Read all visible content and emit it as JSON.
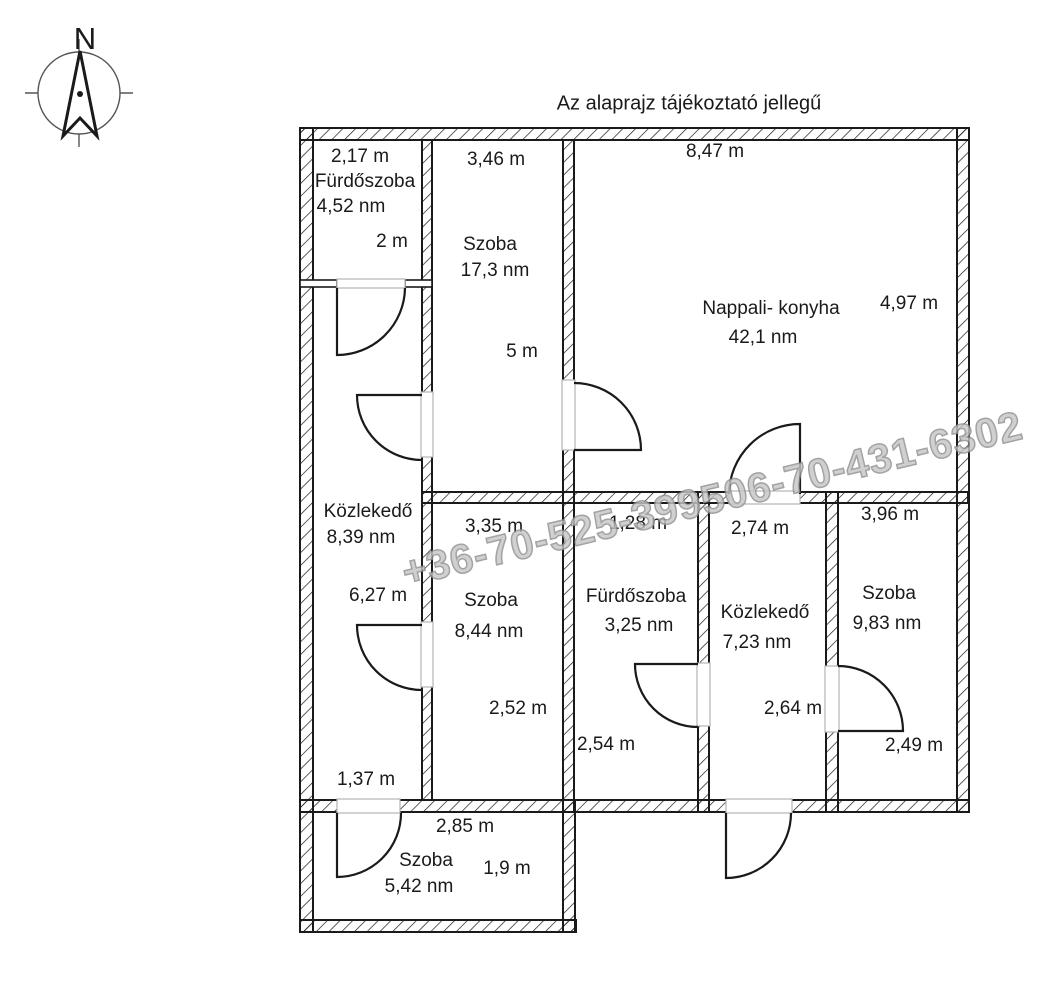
{
  "title": "Az alaprajz tájékoztató jellegű",
  "compass": {
    "north_label": "N"
  },
  "watermark": {
    "text": "+36-70-525-399506-70-431-6302",
    "fill": "#c6c6c6",
    "outline": "#8f8f8f"
  },
  "colors": {
    "wall": "#1a1a1a",
    "opening_jamb": "#b3b3b3",
    "text": "#1a1a1a",
    "background": "#ffffff"
  },
  "rooms": [
    {
      "key": "furdoszoba-felso",
      "name": "Fürdőszoba",
      "area": "4,52 nm",
      "dim_width": "2,17 m",
      "dim_height": "2 m"
    },
    {
      "key": "szoba-1",
      "name": "Szoba",
      "area": "17,3 nm",
      "dim_width": "3,46 m",
      "dim_height": "5 m"
    },
    {
      "key": "nappali-konyha",
      "name": "Nappali- konyha",
      "area": "42,1 nm",
      "dim_width": "8,47 m",
      "dim_height": "4,97 m"
    },
    {
      "key": "kozlekedo-1",
      "name": "Közlekedő",
      "area": "8,39 nm",
      "dim_height": "6,27 m",
      "dim_width": "1,37 m"
    },
    {
      "key": "szoba-2",
      "name": "Szoba",
      "area": "8,44 nm",
      "dim_width": "3,35 m",
      "dim_height": "2,52 m"
    },
    {
      "key": "furdoszoba-also",
      "name": "Fürdőszoba",
      "area": "3,25 nm",
      "dim_width": "1,28 m",
      "dim_height": "2,54 m"
    },
    {
      "key": "kozlekedo-2",
      "name": "Közlekedő",
      "area": "7,23 nm",
      "dim_width": "2,74 m",
      "dim_height": "2,64 m"
    },
    {
      "key": "szoba-3",
      "name": "Szoba",
      "area": "9,83 nm",
      "dim_width": "3,96 m",
      "dim_height": "2,49 m"
    },
    {
      "key": "szoba-4",
      "name": "Szoba",
      "area": "5,42 nm",
      "dim_width": "2,85 m",
      "dim_height": "1,9 m"
    }
  ]
}
